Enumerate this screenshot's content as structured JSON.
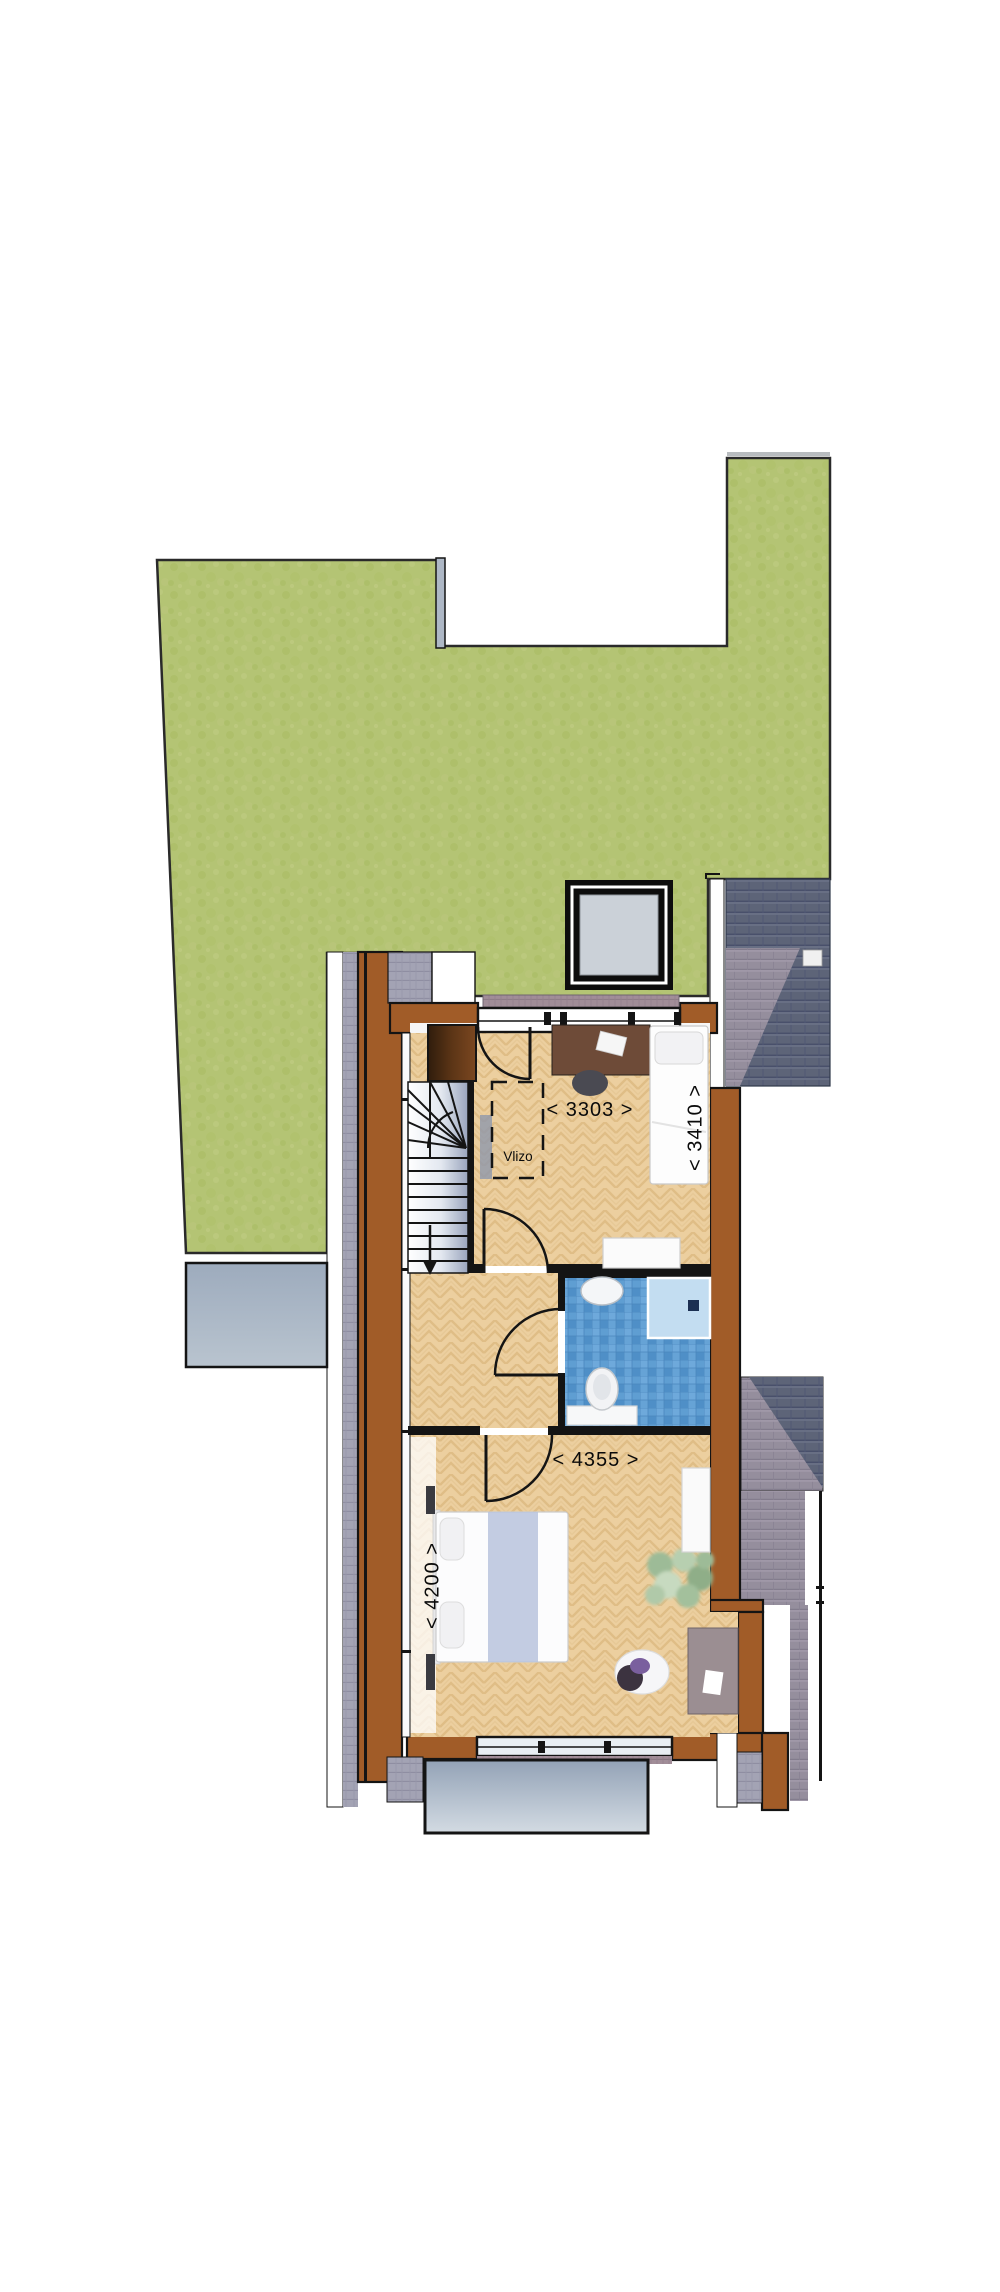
{
  "plan": {
    "labels": {
      "dim_3303": "< 3303 >",
      "dim_3410": "< 3410 >",
      "dim_4355": "< 4355 >",
      "dim_4200": "< 4200 >",
      "vlizo": "Vlizo"
    },
    "rooms": [
      {
        "name": "bedroom-top",
        "width_mm": 3303,
        "depth_mm": 3410
      },
      {
        "name": "bedroom-bottom",
        "width_mm": 4355,
        "depth_mm": 4200
      },
      {
        "name": "bathroom"
      },
      {
        "name": "landing-with-stairs"
      }
    ],
    "features": [
      "vlizo-loft-hatch",
      "winder-staircase-down",
      "skylight",
      "green-sedum-roof",
      "neighbour-tiled-roofs",
      "balcony-south",
      "balcony-west"
    ]
  },
  "colors": {
    "grass": "#b4c474",
    "wall_brown": "#a15c28",
    "wood_floor": "#eccf9f",
    "bathroom_tile": "#5f9ed2",
    "shower_tray": "#c3ddf1",
    "roof_dark": "#5d6478",
    "roof_light": "#958e9d",
    "balcony": "#a9b6c6",
    "outline": "#141414"
  }
}
